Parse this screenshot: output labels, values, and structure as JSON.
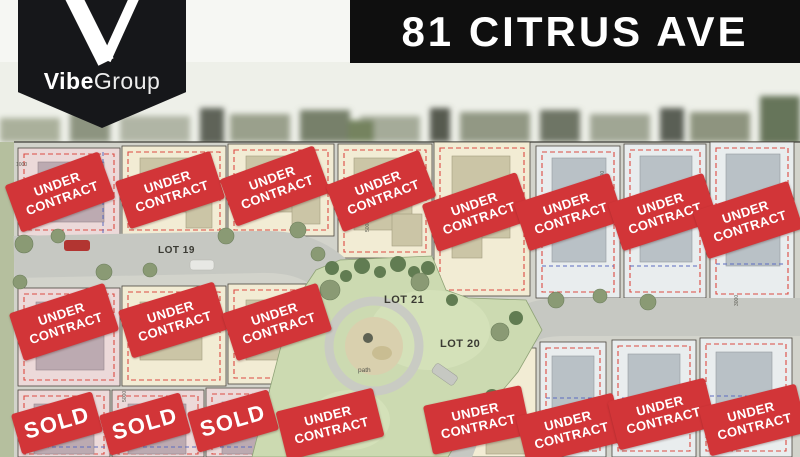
{
  "brand": {
    "monogram": "V",
    "name_bold": "Vibe",
    "name_light": "Group"
  },
  "header": {
    "title": "81 CITRUS AVE"
  },
  "palette": {
    "badge_red": "#D23538",
    "banner_black": "#0F0F0F",
    "park_green": "#CCDAB1",
    "cream_lot": "#F2ECD4",
    "pink_lot": "#ECD9D9",
    "grey_lot": "#E9EDEE",
    "road_grey": "#C6C8C2",
    "setback_dash_red": "#DC4A42",
    "setback_dash_blue": "#5B6CC0"
  },
  "map": {
    "labels": [
      {
        "id": "lot-19",
        "text": "LOT 19"
      },
      {
        "id": "lot-21",
        "text": "LOT 21"
      },
      {
        "id": "lot-20",
        "text": "LOT 20"
      },
      {
        "id": "path",
        "text": "path"
      }
    ],
    "dimensions": [
      {
        "text": "1000"
      },
      {
        "text": "5000"
      },
      {
        "text": "5000"
      },
      {
        "text": "5000"
      },
      {
        "text": "3000"
      }
    ]
  },
  "badges": [
    {
      "label": "UNDER CONTRACT",
      "type": "under_contract",
      "x": 60,
      "y": 192,
      "rot": -20
    },
    {
      "label": "UNDER CONTRACT",
      "type": "under_contract",
      "x": 170,
      "y": 190,
      "rot": -18
    },
    {
      "label": "UNDER CONTRACT",
      "type": "under_contract",
      "x": 275,
      "y": 186,
      "rot": -20
    },
    {
      "label": "UNDER CONTRACT",
      "type": "under_contract",
      "x": 381,
      "y": 191,
      "rot": -21
    },
    {
      "label": "UNDER CONTRACT",
      "type": "under_contract",
      "x": 477,
      "y": 212,
      "rot": -19
    },
    {
      "label": "UNDER CONTRACT",
      "type": "under_contract",
      "x": 569,
      "y": 212,
      "rot": -18
    },
    {
      "label": "UNDER CONTRACT",
      "type": "under_contract",
      "x": 663,
      "y": 212,
      "rot": -18
    },
    {
      "label": "UNDER CONTRACT",
      "type": "under_contract",
      "x": 748,
      "y": 220,
      "rot": -18
    },
    {
      "label": "UNDER CONTRACT",
      "type": "under_contract",
      "x": 64,
      "y": 322,
      "rot": -18
    },
    {
      "label": "UNDER CONTRACT",
      "type": "under_contract",
      "x": 173,
      "y": 320,
      "rot": -17
    },
    {
      "label": "UNDER CONTRACT",
      "type": "under_contract",
      "x": 277,
      "y": 322,
      "rot": -18
    },
    {
      "label": "SOLD",
      "type": "sold",
      "x": 57,
      "y": 423,
      "rot": -16
    },
    {
      "label": "SOLD",
      "type": "sold",
      "x": 145,
      "y": 424,
      "rot": -16
    },
    {
      "label": "SOLD",
      "type": "sold",
      "x": 233,
      "y": 421,
      "rot": -16
    },
    {
      "label": "UNDER CONTRACT",
      "type": "under_contract",
      "x": 330,
      "y": 424,
      "rot": -14
    },
    {
      "label": "UNDER CONTRACT",
      "type": "under_contract",
      "x": 477,
      "y": 420,
      "rot": -12
    },
    {
      "label": "UNDER CONTRACT",
      "type": "under_contract",
      "x": 570,
      "y": 429,
      "rot": -14
    },
    {
      "label": "UNDER CONTRACT",
      "type": "under_contract",
      "x": 662,
      "y": 414,
      "rot": -14
    },
    {
      "label": "UNDER CONTRACT",
      "type": "under_contract",
      "x": 753,
      "y": 420,
      "rot": -14
    }
  ]
}
